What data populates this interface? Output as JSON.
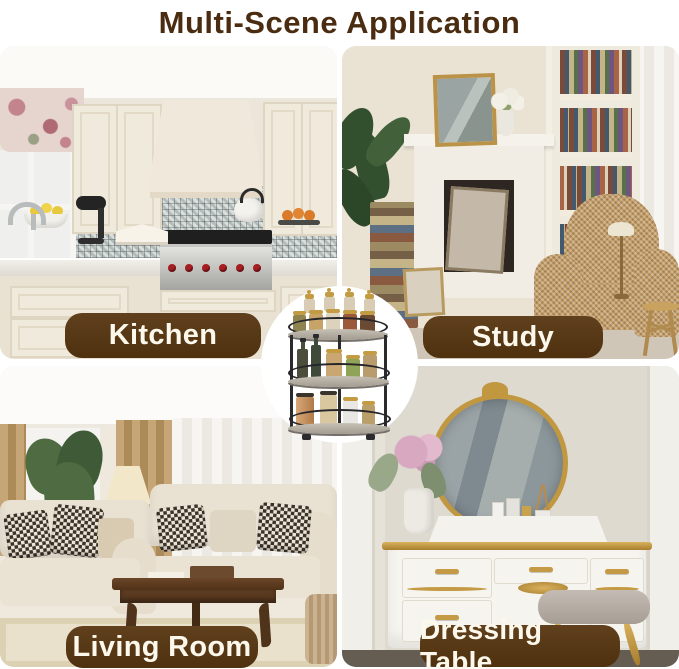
{
  "title": "Multi-Scene Application",
  "colors": {
    "title_text": "#4a2c10",
    "badge_background": "#54350f",
    "badge_text": "#fdf8ec",
    "page_background": "#ffffff"
  },
  "scenes": [
    {
      "id": "kitchen",
      "label": "Kitchen"
    },
    {
      "id": "study",
      "label": "Study"
    },
    {
      "id": "living_room",
      "label": "Living Room"
    },
    {
      "id": "dressing_table",
      "label": "Dressing Table"
    }
  ],
  "product": {
    "icon": "rotating-spice-rack-icon",
    "description": "3-tier round rotating spice rack filled with spice jars, oil bottles and canisters, shown in a white circle at the center"
  }
}
